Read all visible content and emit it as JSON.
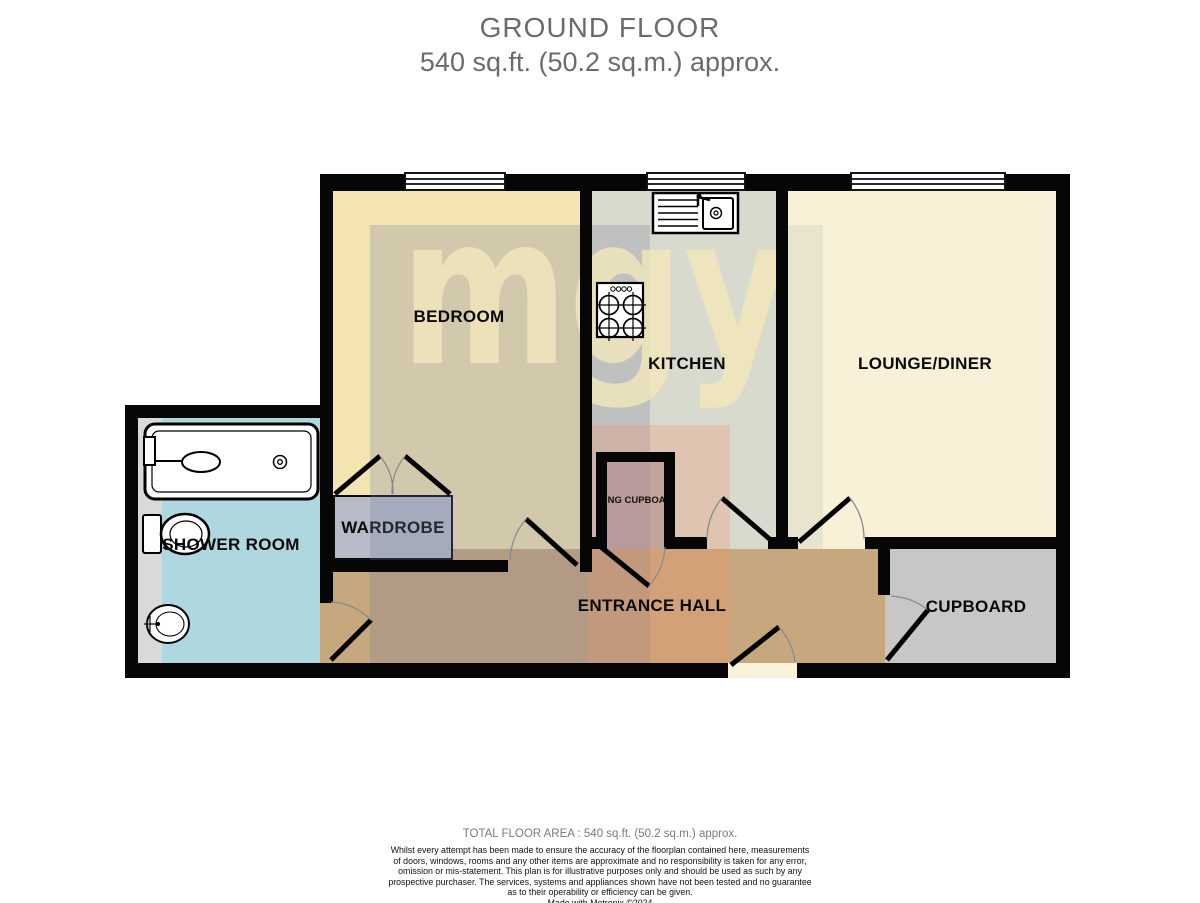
{
  "title": {
    "line1": "GROUND FLOOR",
    "line2": "540 sq.ft. (50.2 sq.m.) approx."
  },
  "watermark": {
    "text": "mgy"
  },
  "rooms": {
    "bedroom": {
      "label": "BEDROOM"
    },
    "kitchen": {
      "label": "KITCHEN"
    },
    "lounge": {
      "label": "LOUNGE/DINER"
    },
    "shower": {
      "label": "SHOWER ROOM"
    },
    "wardrobe": {
      "label": "WARDROBE"
    },
    "hall": {
      "label": "ENTRANCE HALL"
    },
    "cupboard": {
      "label": "CUPBOARD"
    },
    "airing": {
      "label": "AIRING CUPBOARD"
    }
  },
  "fixtures": [
    "bath",
    "toilet",
    "basin",
    "sink-unit",
    "hob",
    "wardrobe"
  ],
  "footer": {
    "total": "TOTAL FLOOR AREA : 540 sq.ft. (50.2 sq.m.) approx.",
    "disclaimer_lines": [
      "Whilst every attempt has been made to ensure the accuracy of the floorplan contained here, measurements",
      "of doors, windows, rooms and any other items are approximate and no responsibility is taken for any error,",
      "omission or mis-statement. This plan is for illustrative purposes only and should be used as such by any",
      "prospective purchaser. The services, systems and appliances shown have not been tested and no guarantee",
      "as to their operability or efficiency can be given."
    ],
    "credit": "Made with Metropix ©2024"
  },
  "colors": {
    "wall": "#060606",
    "bedroom": "#f3e4b1",
    "kitchen": "#d9dace",
    "lounge": "#f8f1d8",
    "hall": "#c7a77d",
    "shower": "#aed7e0",
    "shower_strip": "#d9d9d9",
    "cupboard": "#c7c7c7",
    "airing_cupboard": "#b0a9b1",
    "wardrobe": "#b7bbc7",
    "watermark_text": "#f2e7bc",
    "title_gray": "#6b6b6b"
  }
}
